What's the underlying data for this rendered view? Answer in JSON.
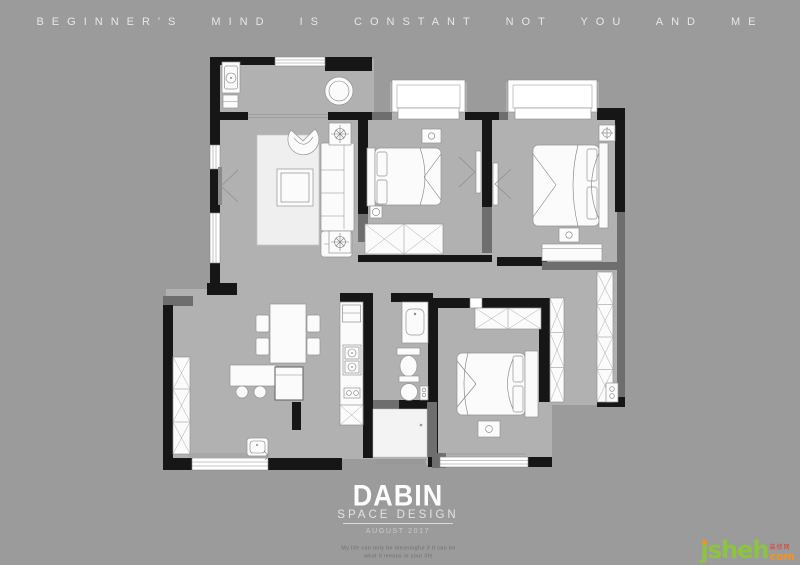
{
  "page": {
    "background_color": "#9b9b9b",
    "width": 800,
    "height": 565
  },
  "header": {
    "slogan": "B E G I N N E R ' S   M I N D   I S   C O N S T A N T   N O T   Y O U   A N D   M E",
    "slogan_plain": "BEGINNER'S MIND IS CONSTANT NOT YOU AND ME"
  },
  "floorplan": {
    "wall_color": "#161616",
    "secondary_wall_color": "#6e6e6e",
    "floor_color": "#b1b1b1",
    "furniture_color": "#fbfbfb",
    "window_color": "#ffffff",
    "rooms": [
      {
        "name": "balcony"
      },
      {
        "name": "living-room"
      },
      {
        "name": "bedroom-top-middle"
      },
      {
        "name": "master-bedroom"
      },
      {
        "name": "walk-in-closet"
      },
      {
        "name": "bedroom-bottom-right"
      },
      {
        "name": "bathroom"
      },
      {
        "name": "kitchen"
      },
      {
        "name": "dining-room"
      },
      {
        "name": "entry"
      }
    ]
  },
  "footer": {
    "brand": "DABIN",
    "studio": "SPACE DESIGN",
    "date": "AUGUST 2017",
    "caption_line1": "My life can only be meaningful if it can be",
    "caption_line2": "what it means in your life"
  },
  "watermark": {
    "site_name": "ȷsheh",
    "site_suffix": "com",
    "site_tag": "装修网",
    "green": "#8bc43f",
    "orange": "#f6921e",
    "red": "#e03e2d"
  }
}
